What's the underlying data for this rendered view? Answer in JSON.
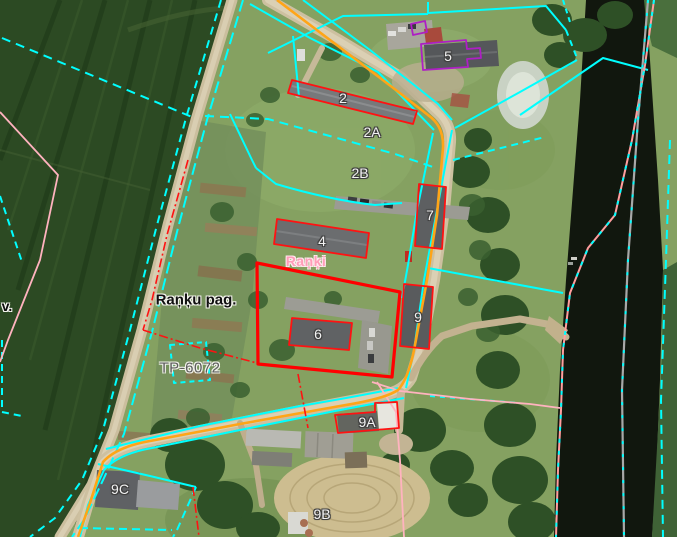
{
  "map": {
    "labels": {
      "building_2": "2",
      "building_2a": "2A",
      "building_2b": "2B",
      "building_4": "4",
      "building_5": "5",
      "building_6": "6",
      "building_7": "7",
      "building_9": "9",
      "building_9a": "9A",
      "building_9b": "9B",
      "building_9c": "9C",
      "village_name": "Raņķi",
      "parish_name": "Raņķu pag.",
      "plan_number": "TP-6072",
      "edge_label": "v."
    },
    "legend_colors": {
      "parcel_boundary_cyan": "#00ffff",
      "selected_parcel_red": "#ff0000",
      "building_outline_red": "#ff1212",
      "road_route_orange": "#ffa517",
      "special_building_purple": "#ae1fc4",
      "boundary_pink": "#ffb3bf",
      "riverbank_salmon": "#ff9e9e",
      "river_axis_gray": "#a8a8a8"
    }
  }
}
